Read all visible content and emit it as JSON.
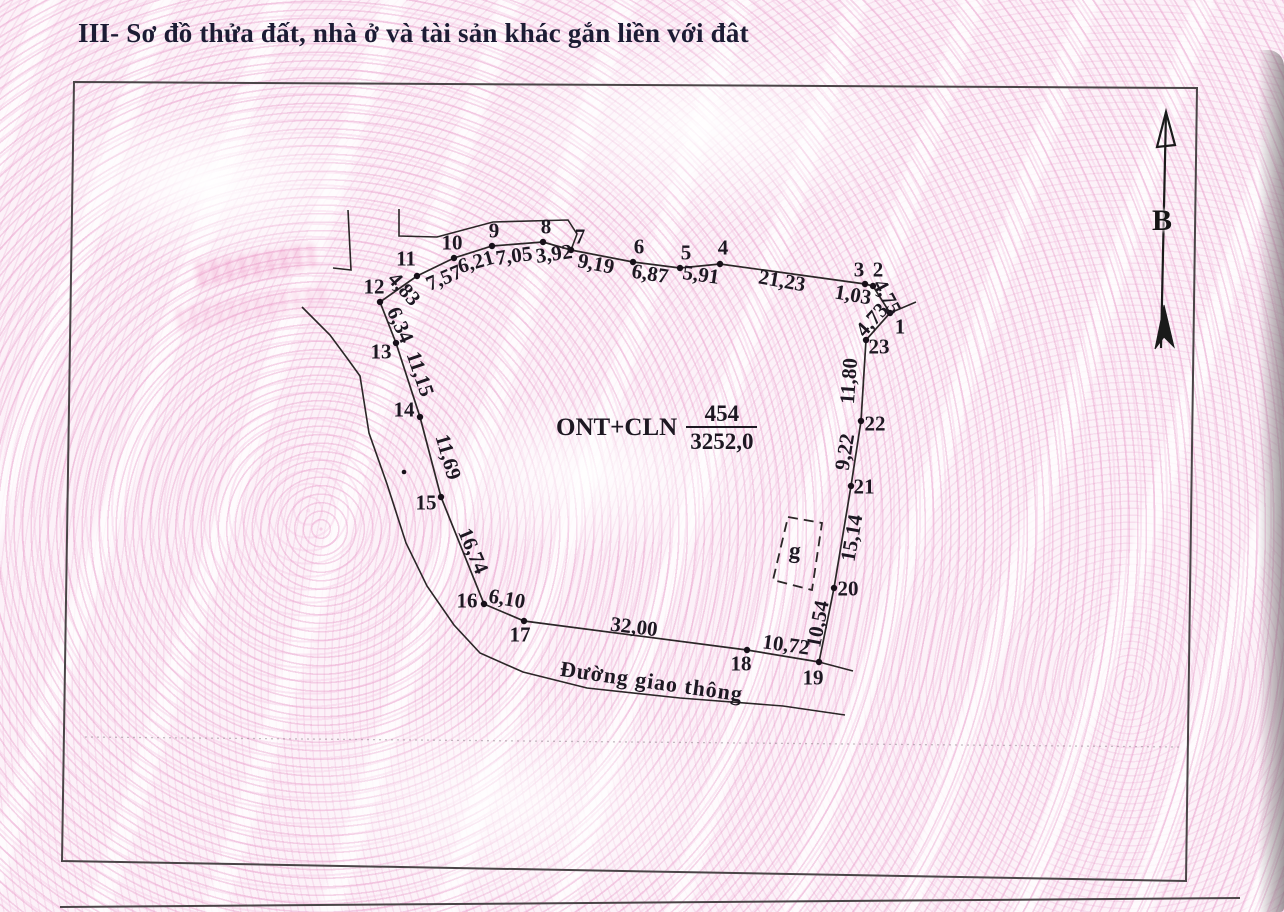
{
  "page": {
    "section_title": "III- Sơ đồ thửa đất, nhà ở và tài sản khác gắn liền với đât",
    "colors": {
      "title": "#1c1c34",
      "line": "#2b2627",
      "background_pink": "#f3d3e7"
    }
  },
  "diagram": {
    "plot_label": {
      "code": "ONT+CLN",
      "numerator": "454",
      "denominator": "3252,0"
    },
    "road_label": {
      "text": "Đường giao thông"
    },
    "structure_label": {
      "text": "g"
    },
    "north_arrow": {
      "label": "B",
      "line": [
        [
          1161,
          348
        ],
        [
          1166,
          112
        ]
      ],
      "head": [
        [
          1166,
          112
        ],
        [
          1157,
          147
        ],
        [
          1175,
          145
        ]
      ],
      "fletch": [
        [
          1164,
          305
        ],
        [
          1174,
          347
        ],
        [
          1164,
          337
        ],
        [
          1155,
          349
        ]
      ]
    },
    "frame": [
      [
        74,
        82
      ],
      [
        1197,
        88
      ],
      [
        1186,
        881
      ],
      [
        62,
        861
      ]
    ],
    "boundary": [
      [
        890,
        313
      ],
      [
        873,
        286
      ],
      [
        865,
        284
      ],
      [
        720,
        264
      ],
      [
        680,
        268
      ],
      [
        633,
        262
      ],
      [
        571,
        250
      ],
      [
        543,
        242
      ],
      [
        492,
        246
      ],
      [
        454,
        258
      ],
      [
        417,
        276
      ],
      [
        380,
        302
      ],
      [
        396,
        343
      ],
      [
        420,
        417
      ],
      [
        441,
        497
      ],
      [
        484,
        604
      ],
      [
        524,
        621
      ],
      [
        747,
        650
      ],
      [
        819,
        662
      ],
      [
        834,
        588
      ],
      [
        851,
        486
      ],
      [
        861,
        421
      ],
      [
        866,
        340
      ]
    ],
    "extension_lines": [
      [
        [
          890,
          313
        ],
        [
          916,
          302
        ]
      ],
      [
        [
          819,
          662
        ],
        [
          853,
          671
        ]
      ]
    ],
    "neighbor_lines": [
      [
        [
          348,
          210
        ],
        [
          351,
          270
        ],
        [
          333,
          268
        ]
      ],
      [
        [
          399,
          209
        ],
        [
          399,
          236
        ],
        [
          437,
          237
        ],
        [
          493,
          222
        ],
        [
          568,
          220
        ],
        [
          577,
          234
        ],
        [
          571,
          250
        ]
      ]
    ],
    "road_line": [
      [
        302,
        307
      ],
      [
        330,
        335
      ],
      [
        347,
        358
      ],
      [
        360,
        376
      ],
      [
        369,
        433
      ],
      [
        387,
        484
      ],
      [
        406,
        543
      ],
      [
        427,
        586
      ],
      [
        454,
        625
      ],
      [
        480,
        653
      ],
      [
        523,
        672
      ],
      [
        587,
        688
      ],
      [
        680,
        698
      ],
      [
        783,
        706
      ],
      [
        845,
        715
      ]
    ],
    "dashed_structure": [
      [
        788,
        517
      ],
      [
        822,
        523
      ],
      [
        812,
        590
      ],
      [
        773,
        580
      ]
    ],
    "faint_line": [
      [
        85,
        737
      ],
      [
        1180,
        747
      ]
    ],
    "section_line": [
      [
        60,
        907
      ],
      [
        1240,
        898
      ]
    ],
    "stray_dots": [
      [
        404,
        472
      ]
    ],
    "vertices": [
      {
        "n": "1",
        "x": 890,
        "y": 313,
        "lx": 900,
        "ly": 327
      },
      {
        "n": "2",
        "x": 873,
        "y": 286,
        "lx": 878,
        "ly": 270
      },
      {
        "n": "3",
        "x": 865,
        "y": 284,
        "lx": 859,
        "ly": 270
      },
      {
        "n": "4",
        "x": 720,
        "y": 264,
        "lx": 723,
        "ly": 248
      },
      {
        "n": "5",
        "x": 680,
        "y": 268,
        "lx": 686,
        "ly": 253
      },
      {
        "n": "6",
        "x": 633,
        "y": 262,
        "lx": 639,
        "ly": 247
      },
      {
        "n": "7",
        "x": 571,
        "y": 250,
        "lx": 580,
        "ly": 237
      },
      {
        "n": "8",
        "x": 543,
        "y": 242,
        "lx": 546,
        "ly": 227
      },
      {
        "n": "9",
        "x": 492,
        "y": 246,
        "lx": 494,
        "ly": 231
      },
      {
        "n": "10",
        "x": 454,
        "y": 258,
        "lx": 452,
        "ly": 243
      },
      {
        "n": "11",
        "x": 417,
        "y": 276,
        "lx": 406,
        "ly": 259
      },
      {
        "n": "12",
        "x": 380,
        "y": 302,
        "lx": 374,
        "ly": 287
      },
      {
        "n": "13",
        "x": 396,
        "y": 343,
        "lx": 381,
        "ly": 352
      },
      {
        "n": "14",
        "x": 420,
        "y": 417,
        "lx": 404,
        "ly": 410
      },
      {
        "n": "15",
        "x": 441,
        "y": 497,
        "lx": 426,
        "ly": 503
      },
      {
        "n": "16",
        "x": 484,
        "y": 604,
        "lx": 467,
        "ly": 601
      },
      {
        "n": "17",
        "x": 524,
        "y": 621,
        "lx": 520,
        "ly": 635
      },
      {
        "n": "18",
        "x": 747,
        "y": 650,
        "lx": 741,
        "ly": 664
      },
      {
        "n": "19",
        "x": 819,
        "y": 662,
        "lx": 813,
        "ly": 678
      },
      {
        "n": "20",
        "x": 834,
        "y": 588,
        "lx": 848,
        "ly": 589
      },
      {
        "n": "21",
        "x": 851,
        "y": 486,
        "lx": 864,
        "ly": 487
      },
      {
        "n": "22",
        "x": 861,
        "y": 421,
        "lx": 875,
        "ly": 424
      },
      {
        "n": "23",
        "x": 866,
        "y": 340,
        "lx": 879,
        "ly": 347
      }
    ],
    "edge_labels": [
      {
        "text": "4,75",
        "x": 887,
        "y": 297,
        "rot": 62
      },
      {
        "text": "1,03",
        "x": 853,
        "y": 295,
        "rot": 10
      },
      {
        "text": "21,23",
        "x": 782,
        "y": 281,
        "rot": 10
      },
      {
        "text": "5,91",
        "x": 701,
        "y": 275,
        "rot": 8
      },
      {
        "text": "6,87",
        "x": 650,
        "y": 274,
        "rot": 9
      },
      {
        "text": "9,19",
        "x": 596,
        "y": 264,
        "rot": 11
      },
      {
        "text": "3,92",
        "x": 554,
        "y": 254,
        "rot": -8
      },
      {
        "text": "7,05",
        "x": 514,
        "y": 256,
        "rot": -8
      },
      {
        "text": "6,21",
        "x": 476,
        "y": 262,
        "rot": -16
      },
      {
        "text": "7,57",
        "x": 444,
        "y": 278,
        "rot": -23
      },
      {
        "text": "4,83",
        "x": 404,
        "y": 289,
        "rot": 48
      },
      {
        "text": "6,34",
        "x": 400,
        "y": 325,
        "rot": 66
      },
      {
        "text": "11,15",
        "x": 420,
        "y": 374,
        "rot": 71
      },
      {
        "text": "11,69",
        "x": 448,
        "y": 457,
        "rot": 74
      },
      {
        "text": "16,74",
        "x": 473,
        "y": 551,
        "rot": 67
      },
      {
        "text": "6,10",
        "x": 507,
        "y": 599,
        "rot": 10
      },
      {
        "text": "32,00",
        "x": 634,
        "y": 627,
        "rot": 7
      },
      {
        "text": "10,72",
        "x": 786,
        "y": 645,
        "rot": 8
      },
      {
        "text": "10,54",
        "x": 818,
        "y": 624,
        "rot": -79
      },
      {
        "text": "15,14",
        "x": 852,
        "y": 538,
        "rot": -80
      },
      {
        "text": "9,22",
        "x": 845,
        "y": 452,
        "rot": -81
      },
      {
        "text": "11,80",
        "x": 849,
        "y": 381,
        "rot": -86
      },
      {
        "text": "4,73",
        "x": 872,
        "y": 320,
        "rot": -48
      }
    ]
  }
}
